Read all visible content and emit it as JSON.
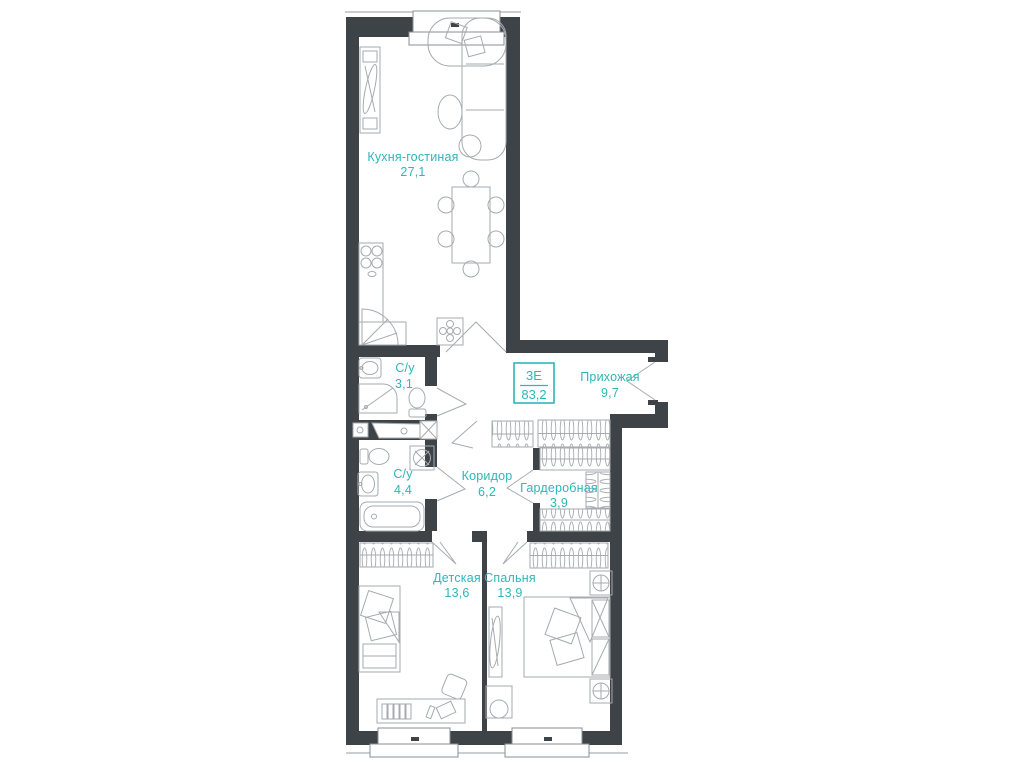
{
  "apartment": {
    "type_label": "3Е",
    "total_area": "83,2"
  },
  "rooms": [
    {
      "key": "kitchen-living",
      "name": "Кухня-гостиная",
      "area": "27,1"
    },
    {
      "key": "bathroom-1",
      "name": "С/у",
      "area": "3,1"
    },
    {
      "key": "hallway",
      "name": "Прихожая",
      "area": "9,7"
    },
    {
      "key": "bathroom-2",
      "name": "С/у",
      "area": "4,4"
    },
    {
      "key": "corridor",
      "name": "Коридор",
      "area": "6,2"
    },
    {
      "key": "wardrobe",
      "name": "Гардеробная",
      "area": "3,9"
    },
    {
      "key": "children-room",
      "name": "Детская",
      "area": "13,6"
    },
    {
      "key": "bedroom",
      "name": "Спальня",
      "area": "13,9"
    }
  ],
  "colors": {
    "wall": "#3E4347",
    "furniture": "#A6ABAF",
    "accent": "#2EB6B9",
    "background": "#FFFFFF"
  }
}
